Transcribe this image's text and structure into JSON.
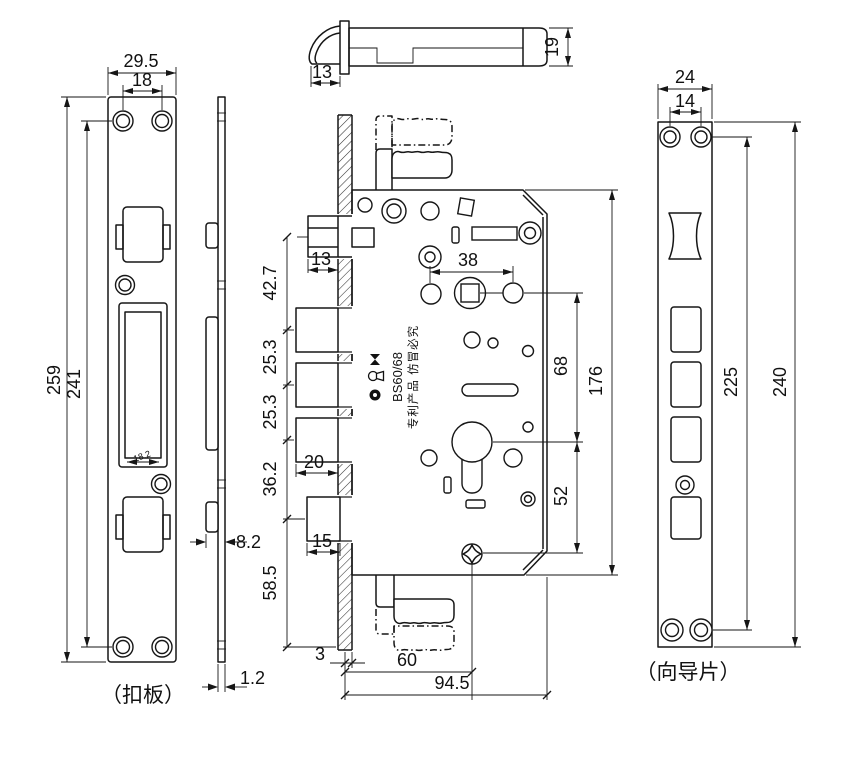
{
  "labels": {
    "strike_plate": "（扣板）",
    "guide_plate": "（向导片）"
  },
  "stamp": {
    "model": "BS60/68",
    "patent": "专利产品 仿冒必究",
    "icons": [
      "brand-circle-icon",
      "keyhole-icon",
      "bowtie-icon"
    ]
  },
  "colors": {
    "line": "#161616",
    "background": "#ffffff",
    "text": "#111111"
  },
  "dimensions": {
    "strike_plate": {
      "outer_width": "29.5",
      "hole_spacing": "18",
      "overall_height": "259",
      "hole_distance": "241",
      "cutout_width": "18.2",
      "tab_depth": "8.2",
      "thickness": "1.2"
    },
    "top_view": {
      "latch_projection": "13",
      "case_thickness": "19"
    },
    "lock_body": {
      "latch_width": "13",
      "spacing_1": "42.7",
      "spacing_2": "25.3",
      "spacing_3": "25.3",
      "spacing_4": "36.2",
      "spacing_5": "58.5",
      "bolt_width": "20",
      "aux_bolt_width": "15",
      "face_offset": "3",
      "backset": "60",
      "depth": "94.5",
      "handle_hole_spacing": "38",
      "spindle_to_cylinder": "68",
      "cylinder_to_bottom": "52",
      "height": "176"
    },
    "guide_plate": {
      "outer_width": "24",
      "hole_spacing": "14",
      "hole_distance": "225",
      "overall_height": "240"
    }
  }
}
